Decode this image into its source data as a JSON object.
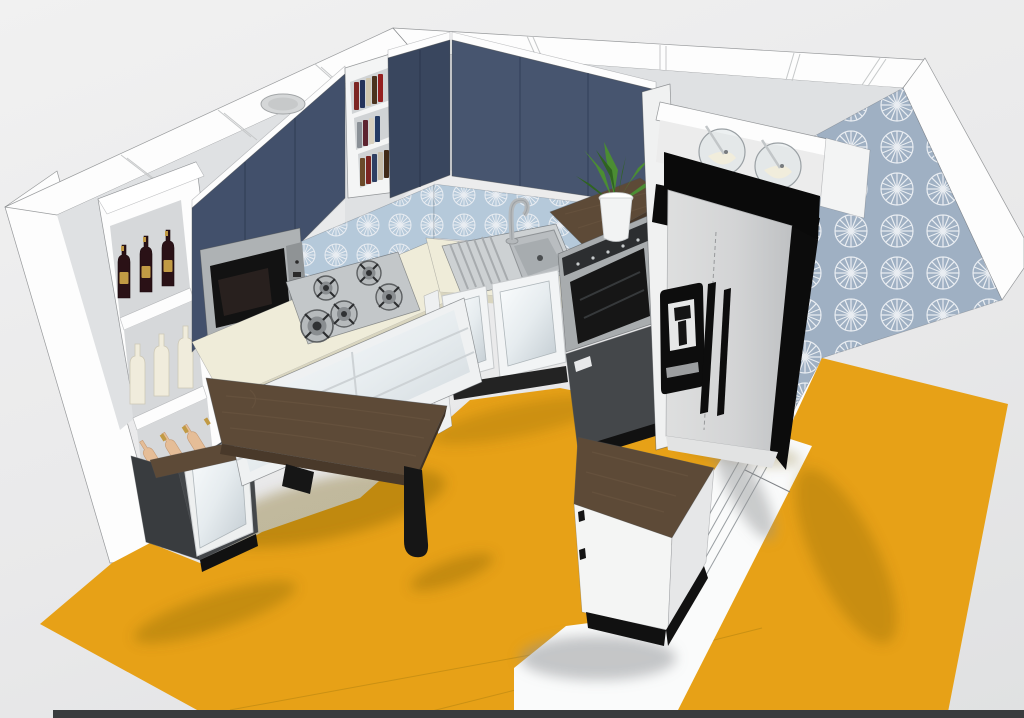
{
  "palette": {
    "bg": "#e9e9ea",
    "outline": "#4b4e52",
    "wallFace": "#fdfdfd",
    "wallInner": "#dfe1e3",
    "wallShade": "#d6d8da",
    "navy": "#42506b",
    "navyDark": "#39465e",
    "navyLight": "#47556f",
    "backsplash": "#b5c9da",
    "wallpaper": "#9fb0c3",
    "fanWhite": "#e9edf2",
    "counter": "#efecd9",
    "counterEdge": "#d9d5bf",
    "wood": "#5d4a37",
    "woodDark": "#49392a",
    "woodGrain": "#6e5943",
    "floor": "#e7a117",
    "floorShadow": "#70550f",
    "floorSeam": "#b28410",
    "strip": "#3a3c3e",
    "steel": "#c3c7c9",
    "steelDark": "#8f9396",
    "black": "#111111",
    "fridge": "#d3d4d5",
    "darkCab": "#44474a",
    "darkCabSide": "#393c3f",
    "mirrorA": "#fbfdfe",
    "mirrorB": "#c3ccd2",
    "white": "#f6f7f7",
    "glass": "#dfe5e7",
    "green": "#4b8d33",
    "greenDark": "#2f6420",
    "cream": "#f1eddc",
    "bottleRed": "#2a1116",
    "bottleGold": "#c19a44",
    "bottleCream": "#f0ecdc",
    "bottleRose": "#e5bd97",
    "grayShadow": "#8f9193"
  },
  "objects": {
    "viewport": {
      "label": "3D kitchen design render viewport"
    },
    "walls": {
      "label": "White room walls seen from above"
    },
    "wallpaper": {
      "label": "Blue fan-pattern wallpaper on right wall"
    },
    "backsplash": {
      "label": "Blue fan-pattern tile backsplash"
    },
    "floor": {
      "label": "Orange floor"
    },
    "doorway": {
      "label": "Doorway threshold strip with guide lines"
    },
    "bottom_bar": {
      "label": "Dark viewport bottom edge"
    },
    "wine_shelf": {
      "label": "Tall open shelf with bottles",
      "red_bottles": 3,
      "white_bottles": 3,
      "rose_bottles": 3
    },
    "dark_base_cabinet": {
      "label": "Charcoal base cabinet with mirror door"
    },
    "upper_cabinets": {
      "label": "Navy blue wall cabinets"
    },
    "bookshelf": {
      "label": "Open shelf column with books",
      "spine_colors": [
        "#7c2522",
        "#24335a",
        "#cfc6ae",
        "#4a321e",
        "#941f1f",
        "#8a9096",
        "#5d2430",
        "#d8d1c0",
        "#243a63",
        "#6b4a2a",
        "#7c2522",
        "#2e3f63",
        "#c8beaa",
        "#402a18"
      ]
    },
    "vent": {
      "label": "Round vent on cabinet top"
    },
    "microwave": {
      "label": "Built-in microwave"
    },
    "counter": {
      "label": "Cream worktop"
    },
    "cooktop": {
      "label": "Gas cooktop",
      "burners": 5
    },
    "sink": {
      "label": "Stainless sink with drainboard and faucet"
    },
    "base_cabinets": {
      "label": "White mirror-front base cabinets and drawers"
    },
    "oven_tower": {
      "label": "Oven in dark tall unit with walnut top"
    },
    "plant": {
      "label": "Potted green plant"
    },
    "tall_panel": {
      "label": "Tall white cabinet side panel"
    },
    "glasses_shelf": {
      "label": "Open shelf with glass coupes",
      "count": 2
    },
    "fridge": {
      "label": "Side-by-side fridge with black ice dispenser"
    },
    "island": {
      "label": "Small island unit with walnut top"
    },
    "table": {
      "label": "Walnut peninsula table with black leg"
    }
  }
}
